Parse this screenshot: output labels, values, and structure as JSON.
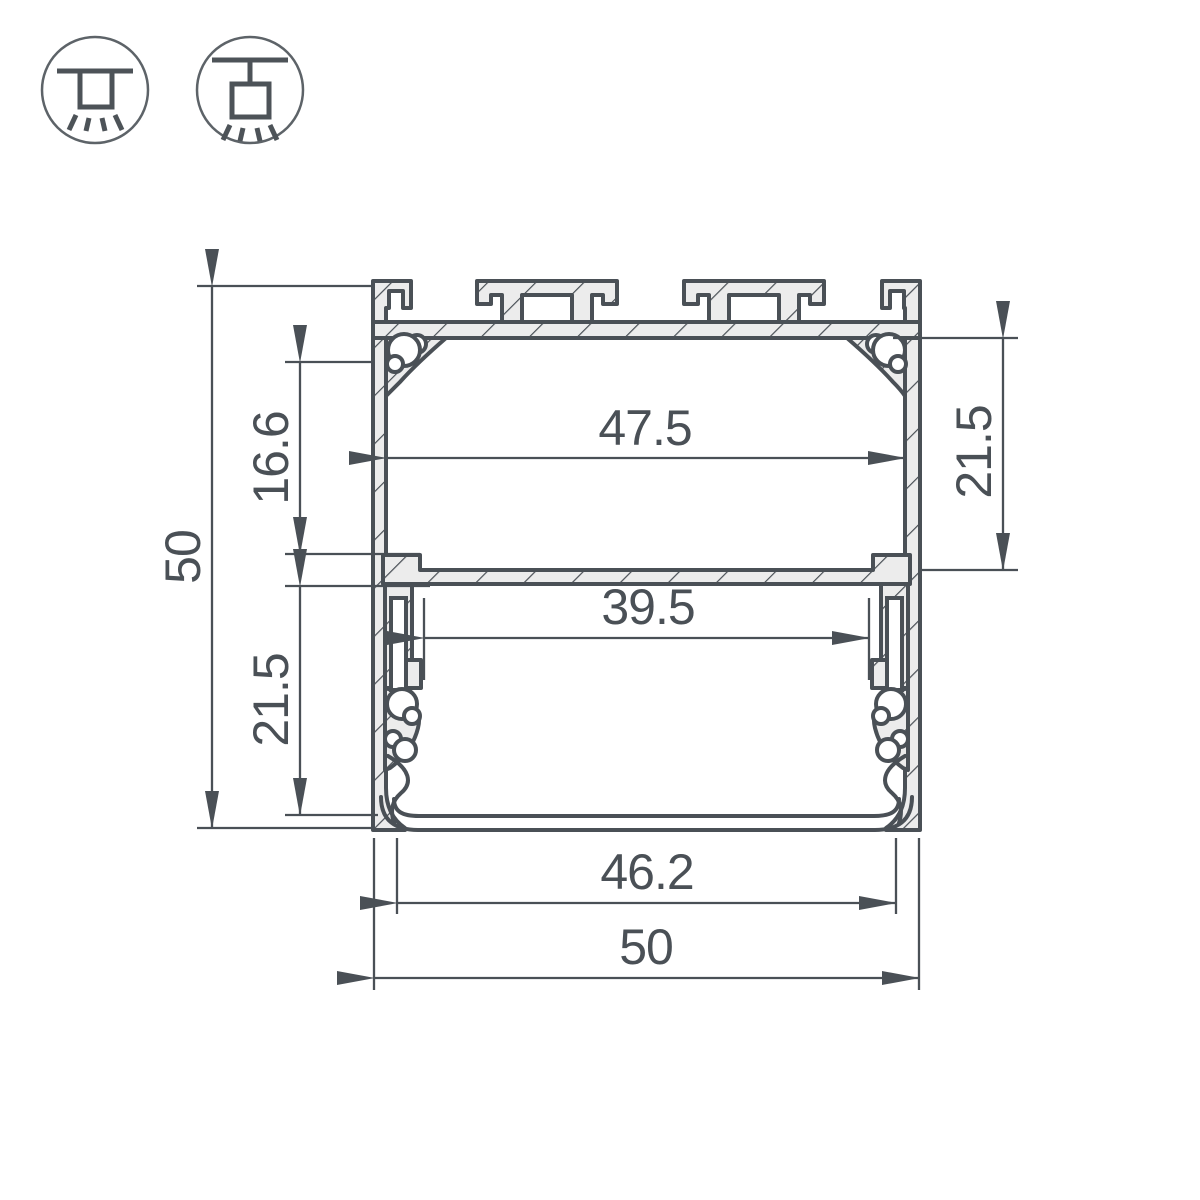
{
  "drawing": {
    "type": "technical-cross-section",
    "subject": "aluminium-led-profile",
    "colors": {
      "line": "#4a5056",
      "metal_fill": "#ececec",
      "icon_circle": "#5d6368",
      "background": "#ffffff"
    },
    "mount_icons": [
      {
        "name": "recessed-ceiling-mount-icon"
      },
      {
        "name": "surface-pendant-mount-icon"
      }
    ],
    "dimensions": {
      "overall_height": "50",
      "upper_cavity_height": "16.6",
      "lower_cavity_height": "21.5",
      "upper_cavity_width": "47.5",
      "right_cavity_height": "21.5",
      "inner_shelf_width": "39.5",
      "bottom_opening_width": "46.2",
      "overall_width": "50"
    }
  }
}
